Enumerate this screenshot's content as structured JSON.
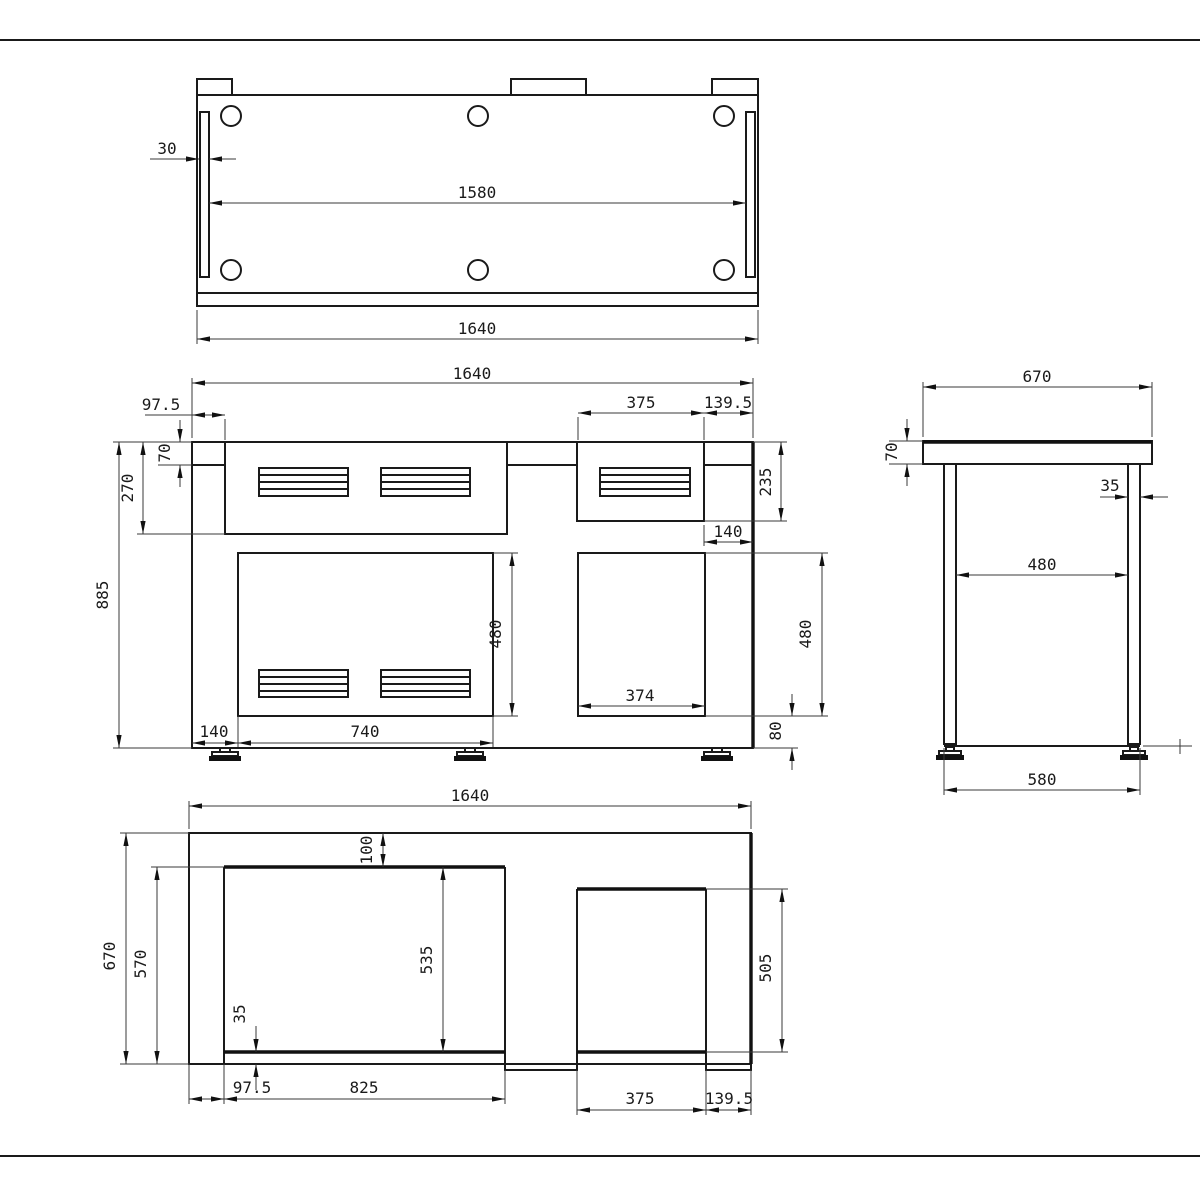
{
  "sheet": {
    "background": "#ffffff",
    "line_color": "#1a1a1a",
    "accent_color": "#111111"
  },
  "views": {
    "top": {
      "label": "top-view",
      "dims": {
        "groove_width": "30",
        "hole_span": "1580",
        "overall_width": "1640"
      }
    },
    "front": {
      "label": "front-view",
      "dims": {
        "overall_width": "1640",
        "left_offset": "97.5",
        "upper_right_panel_width": "375",
        "upper_right_margin": "139.5",
        "top_thickness": "70",
        "upper_panel_height": "270",
        "overall_height": "885",
        "upper_right_panel_height": "235",
        "right_gap": "140",
        "mid_panel_height": "480",
        "right_panel_height": "480",
        "lower_right_panel_width": "374",
        "bottom_clearance": "80",
        "bottom_left_margin": "140",
        "lower_left_panel_width": "740"
      }
    },
    "side": {
      "label": "side-view",
      "dims": {
        "depth": "670",
        "top_thickness": "70",
        "leg_thickness": "35",
        "leg_inner_span": "480",
        "base_span": "580"
      }
    },
    "bottom": {
      "label": "bottom-view",
      "dims": {
        "overall_width": "1640",
        "overall_depth": "670",
        "inner_depth": "570",
        "left_cutout_height": "535",
        "top_rail_width": "100",
        "bottom_rail_width": "35",
        "left_margin": "97.5",
        "left_cutout_width": "825",
        "right_cutout_width": "375",
        "right_margin": "139.5",
        "right_cutout_depth": "505"
      }
    }
  }
}
